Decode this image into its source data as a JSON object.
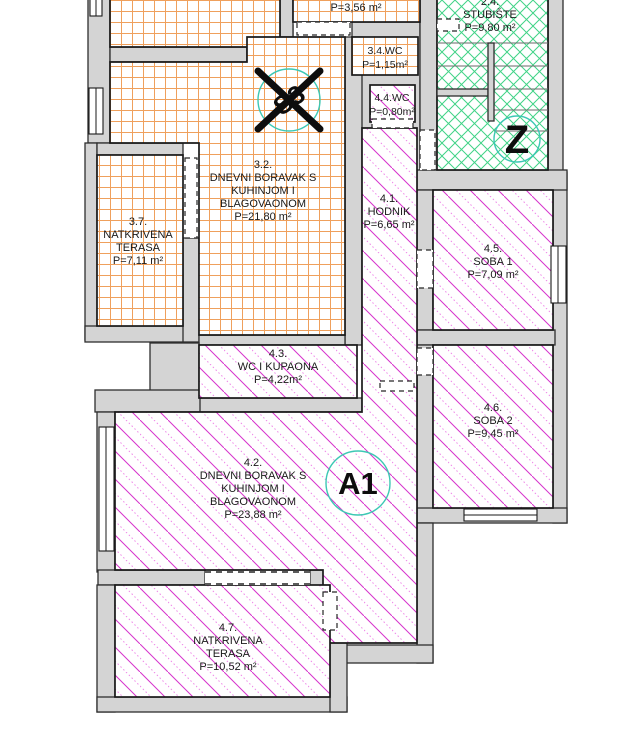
{
  "colors": {
    "wall_fill": "#d4d4d4",
    "outline": "#2e2e2e",
    "unit3_hatch": "#efa05c",
    "staircase_hatch": "#41d387",
    "unit4_hatch": "#d633cc",
    "unit4_hatch_light": "#ef86e8",
    "circle_stroke": "#3cc8b4",
    "text_color": "#1a1a1a"
  },
  "rooms": {
    "top": {
      "area": "P=3,56 m²"
    },
    "stubiste": {
      "number": "2.4.",
      "name": "STUBIŠTE",
      "area": "P=9,80 m²"
    },
    "r32": {
      "number": "3.2.",
      "line1": "DNEVNI BORAVAK S",
      "line2": "KUHINJOM I",
      "line3": "BLAGOVAONOM",
      "area": "P=21,80 m²"
    },
    "r34wc": {
      "name": "3.4.WC",
      "area": "P=1,15m²"
    },
    "r37": {
      "number": "3.7.",
      "line1": "NATKRIVENA",
      "line2": "TERASA",
      "area": "P=7,11 m²"
    },
    "r41": {
      "number": "4.1.",
      "name": "HODNIK",
      "area": "P=6,65 m²"
    },
    "r42": {
      "number": "4.2.",
      "line1": "DNEVNI BORAVAK S",
      "line2": "KUHINJOM I",
      "line3": "BLAGOVAONOM",
      "area": "P=23,88 m²"
    },
    "r43": {
      "number": "4.3.",
      "name": "WC I KUPAONA",
      "area": "P=4,22m²"
    },
    "r44wc": {
      "name": "4.4.WC",
      "area": "P=0,80m²"
    },
    "r45": {
      "number": "4.5.",
      "name": "SOBA 1",
      "area": "P=7,09 m²"
    },
    "r46": {
      "number": "4.6.",
      "name": "SOBA 2",
      "area": "P=9,45 m²"
    },
    "r47": {
      "number": "4.7.",
      "line1": "NATKRIVENA",
      "line2": "TERASA",
      "area": "P=10,52 m²"
    }
  },
  "markers": {
    "crossed_unit": "S3",
    "staircase": "Z",
    "apartment": "A1"
  }
}
